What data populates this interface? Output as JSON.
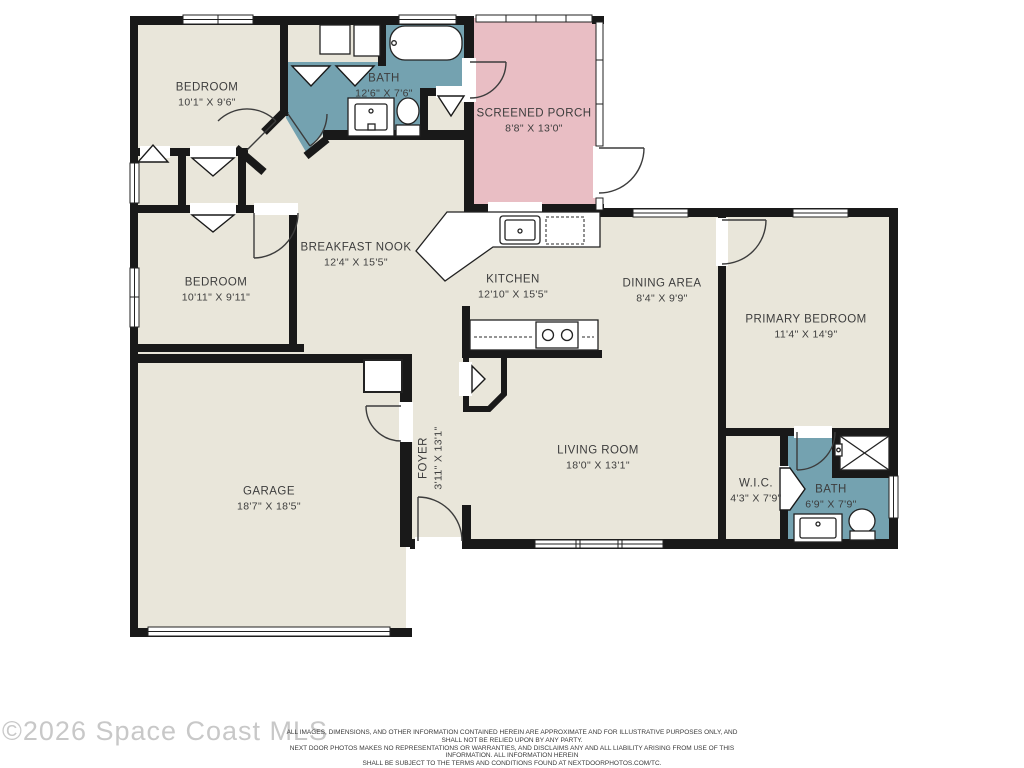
{
  "rooms": [
    {
      "id": "bedroom-1",
      "name": "BEDROOM",
      "dims": "10'1\" X 9'6\""
    },
    {
      "id": "bath-1",
      "name": "BATH",
      "dims": "12'6\" X 7'6\""
    },
    {
      "id": "screened-porch",
      "name": "SCREENED PORCH",
      "dims": "8'8\" X 13'0\""
    },
    {
      "id": "bedroom-2",
      "name": "BEDROOM",
      "dims": "10'11\" X 9'11\""
    },
    {
      "id": "breakfast-nook",
      "name": "BREAKFAST NOOK",
      "dims": "12'4\" X 15'5\""
    },
    {
      "id": "kitchen",
      "name": "KITCHEN",
      "dims": "12'10\" X 15'5\""
    },
    {
      "id": "dining-area",
      "name": "DINING AREA",
      "dims": "8'4\" X 9'9\""
    },
    {
      "id": "primary-bedroom",
      "name": "PRIMARY BEDROOM",
      "dims": "11'4\" X 14'9\""
    },
    {
      "id": "garage",
      "name": "GARAGE",
      "dims": "18'7\" X 18'5\""
    },
    {
      "id": "foyer",
      "name": "FOYER",
      "dims": "3'11\" X 13'1\""
    },
    {
      "id": "living-room",
      "name": "LIVING ROOM",
      "dims": "18'0\" X 13'1\""
    },
    {
      "id": "wic",
      "name": "W.I.C.",
      "dims": "4'3\" X 7'9\""
    },
    {
      "id": "bath-2",
      "name": "BATH",
      "dims": "6'9\" X 7'9\""
    }
  ],
  "footer": {
    "copyright": "©2026 Space Coast MLS",
    "disclaimer": [
      "ALL IMAGES, DIMENSIONS, AND OTHER INFORMATION CONTAINED HEREIN ARE APPROXIMATE AND FOR ILLUSTRATIVE PURPOSES ONLY, AND SHALL NOT BE RELIED UPON BY ANY PARTY.",
      "NEXT DOOR PHOTOS MAKES NO REPRESENTATIONS OR WARRANTIES, AND DISCLAIMS ANY AND ALL LIABILITY ARISING FROM USE OF THIS INFORMATION. ALL INFORMATION HEREIN",
      "SHALL BE SUBJECT TO THE TERMS AND CONDITIONS FOUND AT NEXTDOORPHOTOS.COM/TC."
    ]
  },
  "colors": {
    "floor": "#e9e6da",
    "bath": "#74a2b0",
    "porch": "#e9bec4",
    "wall": "#191919"
  }
}
